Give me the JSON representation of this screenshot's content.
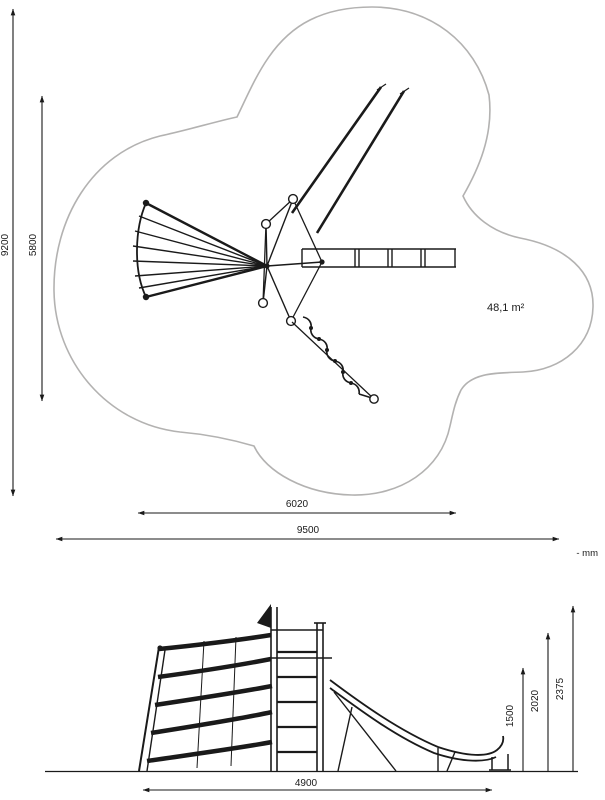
{
  "drawing": {
    "units_note": "- mm",
    "plan_view": {
      "area_label": "48,1 m²",
      "safety_zone_width": "9500",
      "equipment_width": "6020",
      "safety_zone_depth": "9200",
      "equipment_depth": "5800"
    },
    "side_view": {
      "equipment_length": "4900",
      "height_low": "1500",
      "height_mid": "2020",
      "height_top": "2375"
    },
    "colors": {
      "line": "#1a1a1a",
      "safety_outline": "#b3b2b1"
    }
  }
}
